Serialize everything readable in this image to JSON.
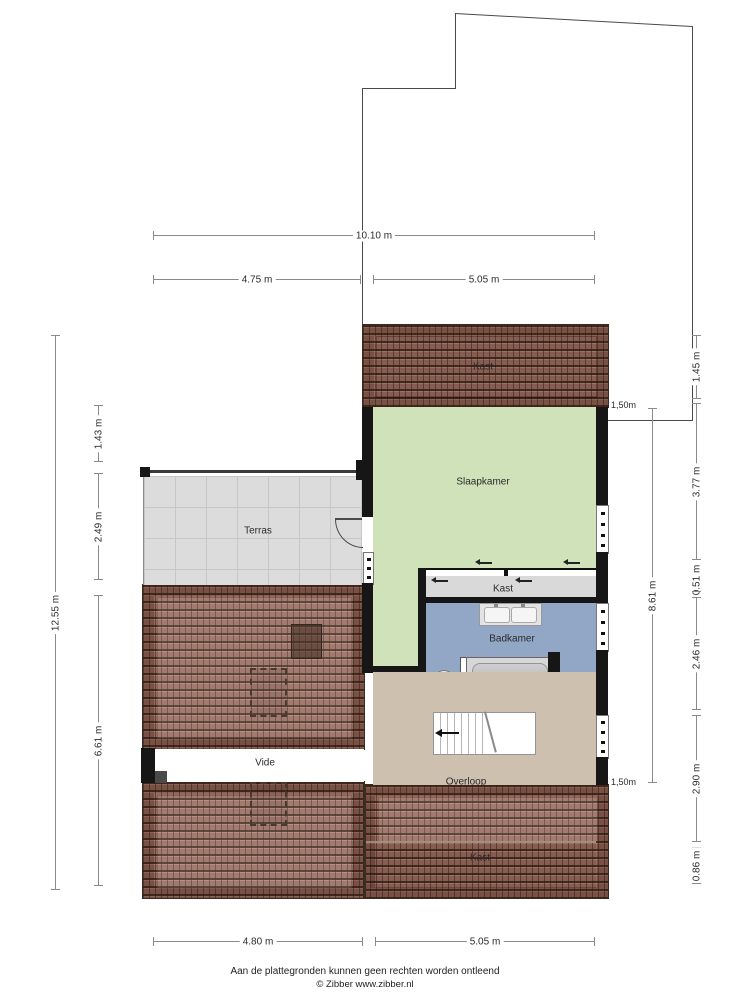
{
  "title": "Floor plan - first floor (attic) with terrace",
  "rooms": {
    "kast_top": "Kast",
    "slaapkamer": "Slaapkamer",
    "terras": "Terras",
    "kast_mid": "Kast",
    "badkamer": "Badkamer",
    "vide": "Vide",
    "overloop": "Overloop",
    "kast_bottom": "Kast"
  },
  "dimensions": {
    "top_total": "10.10 m",
    "top_left": "4.75 m",
    "top_right": "5.05 m",
    "bottom_left": "4.80 m",
    "bottom_right": "5.05 m",
    "left_total": "12.55 m",
    "left_seg1": "1.43 m",
    "left_seg2": "2.49 m",
    "left_seg3": "6.61 m",
    "right_seg1": "1.45 m",
    "right_seg2": "3.77 m",
    "right_seg3": "0.51 m",
    "right_seg4": "2.46 m",
    "right_seg5": "2.90 m",
    "right_seg6": "0.86 m",
    "right_inner": "8.61 m",
    "height_line_top": "1,50m",
    "height_line_bottom": "1,50m"
  },
  "footer": {
    "line1": "Aan de plattegronden kunnen geen rechten worden ontleend",
    "line2": "© Zibber www.zibber.nl"
  },
  "colors": {
    "roof": "#96685a",
    "bedroom_green": "#cfe2ba",
    "bathroom_blue": "#91a7c5",
    "landing_tan": "#cdc0ae",
    "closet_grey": "#d9d9d9",
    "wall_black": "#161616"
  }
}
